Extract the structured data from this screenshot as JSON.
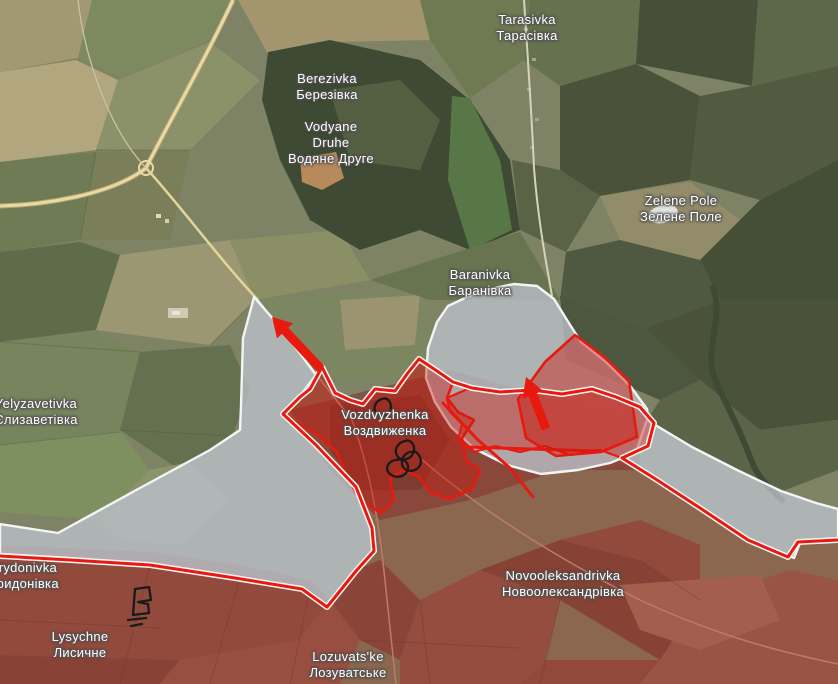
{
  "map": {
    "kind": "satellite-frontline-map",
    "places": [
      {
        "id": "tarasivka",
        "lines": [
          "Tarasivka",
          "Тарасівка"
        ],
        "x": 527,
        "y": 28
      },
      {
        "id": "berezivka",
        "lines": [
          "Berezivka",
          "Березівка"
        ],
        "x": 327,
        "y": 87
      },
      {
        "id": "vodyane-druhe",
        "lines": [
          "Vodyane",
          "Druhe",
          "Водяне Друге"
        ],
        "x": 331,
        "y": 143
      },
      {
        "id": "zelene-pole",
        "lines": [
          "Zelene Pole",
          "Зелене Поле"
        ],
        "x": 681,
        "y": 209
      },
      {
        "id": "baranivka",
        "lines": [
          "Baranivka",
          "Баранівка"
        ],
        "x": 480,
        "y": 283
      },
      {
        "id": "vozdvyzhenka",
        "lines": [
          "Vozdvyzhenka",
          "Воздвиженка"
        ],
        "x": 385,
        "y": 423
      },
      {
        "id": "yelyzavetivka",
        "lines": [
          "Yelyzavetivka",
          "Єлизаветівка"
        ],
        "x": 36,
        "y": 412
      },
      {
        "id": "trydonivka",
        "lines": [
          "Trydonivka",
          "Тридонівка"
        ],
        "x": 24,
        "y": 576
      },
      {
        "id": "lysychne",
        "lines": [
          "Lysychne",
          "Лисичне"
        ],
        "x": 80,
        "y": 645
      },
      {
        "id": "lozuvatske",
        "lines": [
          "Lozuvats'ke",
          "Лозуватське"
        ],
        "x": 348,
        "y": 665
      },
      {
        "id": "novooleksandrivka",
        "lines": [
          "Novooleksandrivka",
          "Новоолександрівка"
        ],
        "x": 563,
        "y": 584
      }
    ],
    "overlays": {
      "advance_arrows": [
        {
          "id": "northwest-advance-arrow",
          "from": [
            321,
            369
          ],
          "to": [
            272,
            317
          ]
        },
        {
          "id": "north-advance-arrow",
          "from": [
            546,
            429
          ],
          "to": [
            526,
            377
          ]
        }
      ],
      "ink_marks": [
        {
          "id": "ink-loop-vozdvyzhenka-north",
          "near": [
            382,
            407
          ]
        },
        {
          "id": "ink-chain-vozdvyzhenka-south",
          "near": [
            406,
            458
          ]
        },
        {
          "id": "ink-flag-trydonivka",
          "near": [
            140,
            604
          ]
        }
      ]
    },
    "colors": {
      "frontline_red": "#e8190f",
      "salient_fill": "rgba(200,28,16,0.42)",
      "assault_fill": "rgba(205,25,15,0.45)",
      "occupied_tint": "rgba(165,40,28,0.30)",
      "gray_zone_fill": "rgba(187,194,202,0.78)",
      "zone_border_white": "#f2f5f4",
      "arrow_red": "#e8190f",
      "annotation_ink": "#1a1a1a",
      "road_yellow": "#ead9a0",
      "label_text": "#ffffff",
      "label_halo": "#4f4f4f"
    }
  }
}
